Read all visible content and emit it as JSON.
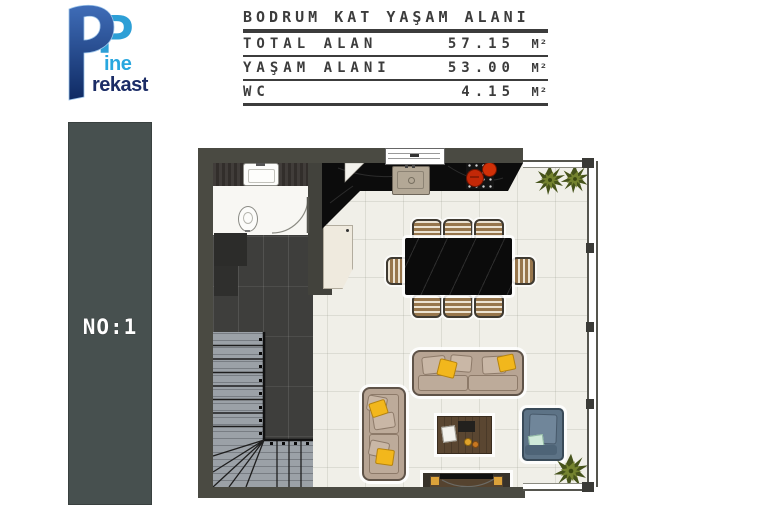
{
  "logo": {
    "brand_p": "P",
    "brand_line1": "ine",
    "brand_line2": "rekast",
    "color_light_blue": "#2d9fd6",
    "color_dark_blue": "#1b2c66"
  },
  "unit_badge": {
    "label": "NO:1"
  },
  "title_block": {
    "title": "BODRUM KAT YAŞAM ALANI",
    "rows": [
      {
        "label": "TOTAL ALAN",
        "value": "57.15",
        "unit": "M²"
      },
      {
        "label": "YAŞAM ALANI",
        "value": "53.00",
        "unit": "M²"
      },
      {
        "label": "WC",
        "value": "4.15",
        "unit": "M²"
      }
    ]
  },
  "floor_plan": {
    "type": "basement-living-area-plan",
    "elements": [
      "wc-with-toilet-and-sink",
      "stairs-with-winder",
      "kitchen-counter-with-sink-and-cooktop",
      "dining-table-8-chairs",
      "large-sofa",
      "small-sofa",
      "coffee-table",
      "armchair",
      "tv-console",
      "plants",
      "window-wall"
    ],
    "colors": {
      "wall": "#4a4a42",
      "tile_floor": "#3e3e3c",
      "main_floor": "#f0efe8",
      "marble_black": "#0b0b0b",
      "sofa_tan": "#b7a493",
      "pillow_yellow": "#f2b71c",
      "armchair_blue": "#5d7386",
      "plant_green": "#74832f",
      "pot_red": "#c32807",
      "stairs_gray": "#9ba1a7",
      "badge_bar": "#47504f"
    }
  }
}
